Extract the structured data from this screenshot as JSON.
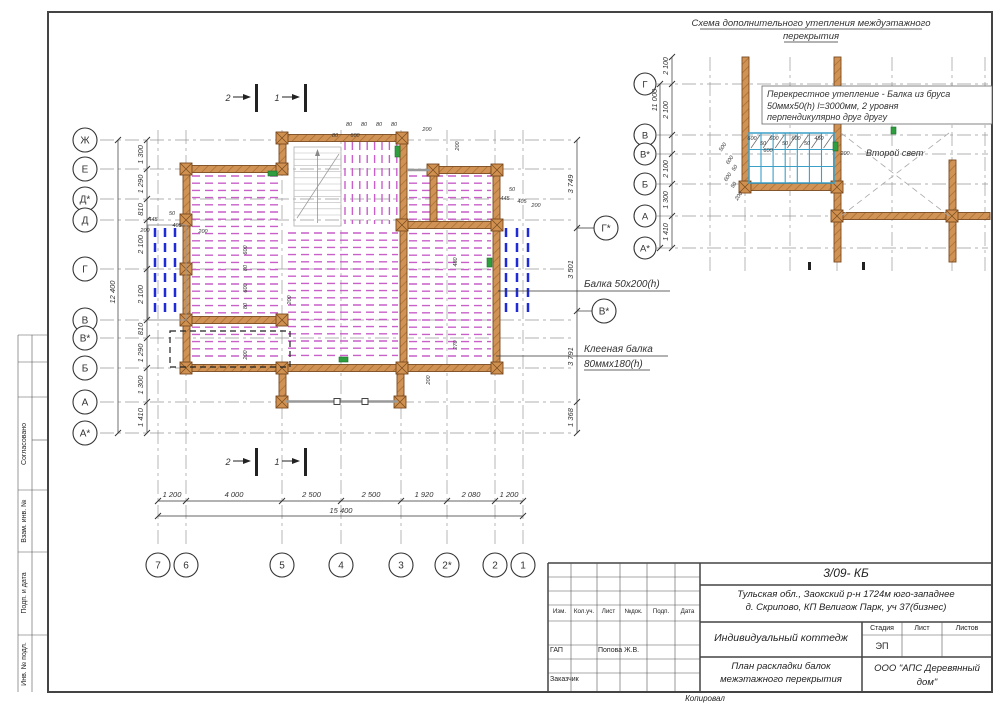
{
  "detail": {
    "title_line1": "Схема дополнительного утепления междуэтажного",
    "title_line2": "перекрытия",
    "note_line1": "Перекрестное утепление -  Балка из бруса",
    "note_line2": "50ммх50(h) l=3000мм, 2 уровня",
    "note_line3": "перпендикулярно друг другу",
    "second_light_label": "Второй свет",
    "axis_rows": [
      "Г",
      "В",
      "В*",
      "Б",
      "А",
      "А*"
    ],
    "dims": [
      "2 100",
      "2 100",
      "2 100",
      "1 300",
      "1 410"
    ],
    "overall_dim": "11 000",
    "small_dims": [
      "600",
      "50",
      "600",
      "50",
      "600",
      "50",
      "450",
      "600",
      "200",
      "500",
      "600",
      "50",
      "600",
      "50",
      "200"
    ]
  },
  "plan": {
    "axis_rows": [
      "Ж",
      "Е",
      "Д*",
      "Д",
      "Г",
      "В",
      "В*",
      "Б",
      "А",
      "А*"
    ],
    "row_dims": [
      "1 300",
      "1 290",
      "810",
      "2 100",
      "2 100",
      "810",
      "1 290",
      "1 300",
      "1 410"
    ],
    "rows_overall": "12 400",
    "axis_cols": [
      "7",
      "6",
      "5",
      "4",
      "3",
      "2*",
      "2",
      "1"
    ],
    "col_dims": [
      "1 200",
      "4 000",
      "2 500",
      "2 500",
      "1 920",
      "2 080",
      "1 200"
    ],
    "cols_overall": "15 400",
    "right_axis": [
      "Г*",
      "В*"
    ],
    "right_dims": [
      "3 749",
      "3 501",
      "3 791",
      "1 368"
    ],
    "beam_note_1": "Балка 50x200(h)",
    "beam_note_2_l1": "Клееная балка",
    "beam_note_2_l2": "80ммх180(h)",
    "section_markers": [
      "2",
      "1"
    ],
    "inline_dims": [
      "80",
      "80",
      "80",
      "80",
      "200",
      "600",
      "80",
      "200",
      "50",
      "445",
      "405",
      "200",
      "50",
      "445",
      "405",
      "200",
      "600",
      "80",
      "600",
      "80",
      "200",
      "480",
      "270",
      "200",
      "200",
      "200"
    ]
  },
  "left_stamp": {
    "sections": [
      "Согласовано",
      "Взам. инв. №",
      "Подп. и дата",
      "Инв. № подл."
    ]
  },
  "title_block": {
    "doc_number": "3/09- КБ",
    "address_l1": "Тульская обл., Заокский р-н 1724м юго-западнее",
    "address_l2": "д. Скрипово, КП Велигож Парк, уч 37(бизнес)",
    "object_name": "Индивидуальный коттедж",
    "sheet_name_l1": "План раскладки балок",
    "sheet_name_l2": "межэтажного перекрытия",
    "company_l1": "ООО \"АПС Деревянный",
    "company_l2": "дом\"",
    "stage_label": "Стадия",
    "sheet_label": "Лист",
    "sheets_label": "Листов",
    "stage_value": "ЭП",
    "header_cols": [
      "Изм.",
      "Кол.уч.",
      "Лист",
      "№док.",
      "Подп.",
      "Дата"
    ],
    "gap_label": "ГАП",
    "gap_value": "Попова Ж.В.",
    "customer_label": "Заказчик",
    "copied_label": "Копировал"
  },
  "colors": {
    "wall": "#cf9050",
    "wall_edge": "#7a4a1f",
    "beam_magenta": "#c95fc9",
    "beam_blue": "#1f2bd6",
    "grid_cyan": "#3aa0c8",
    "marker_green": "#2e9e3e",
    "axis_gray": "#999999"
  }
}
